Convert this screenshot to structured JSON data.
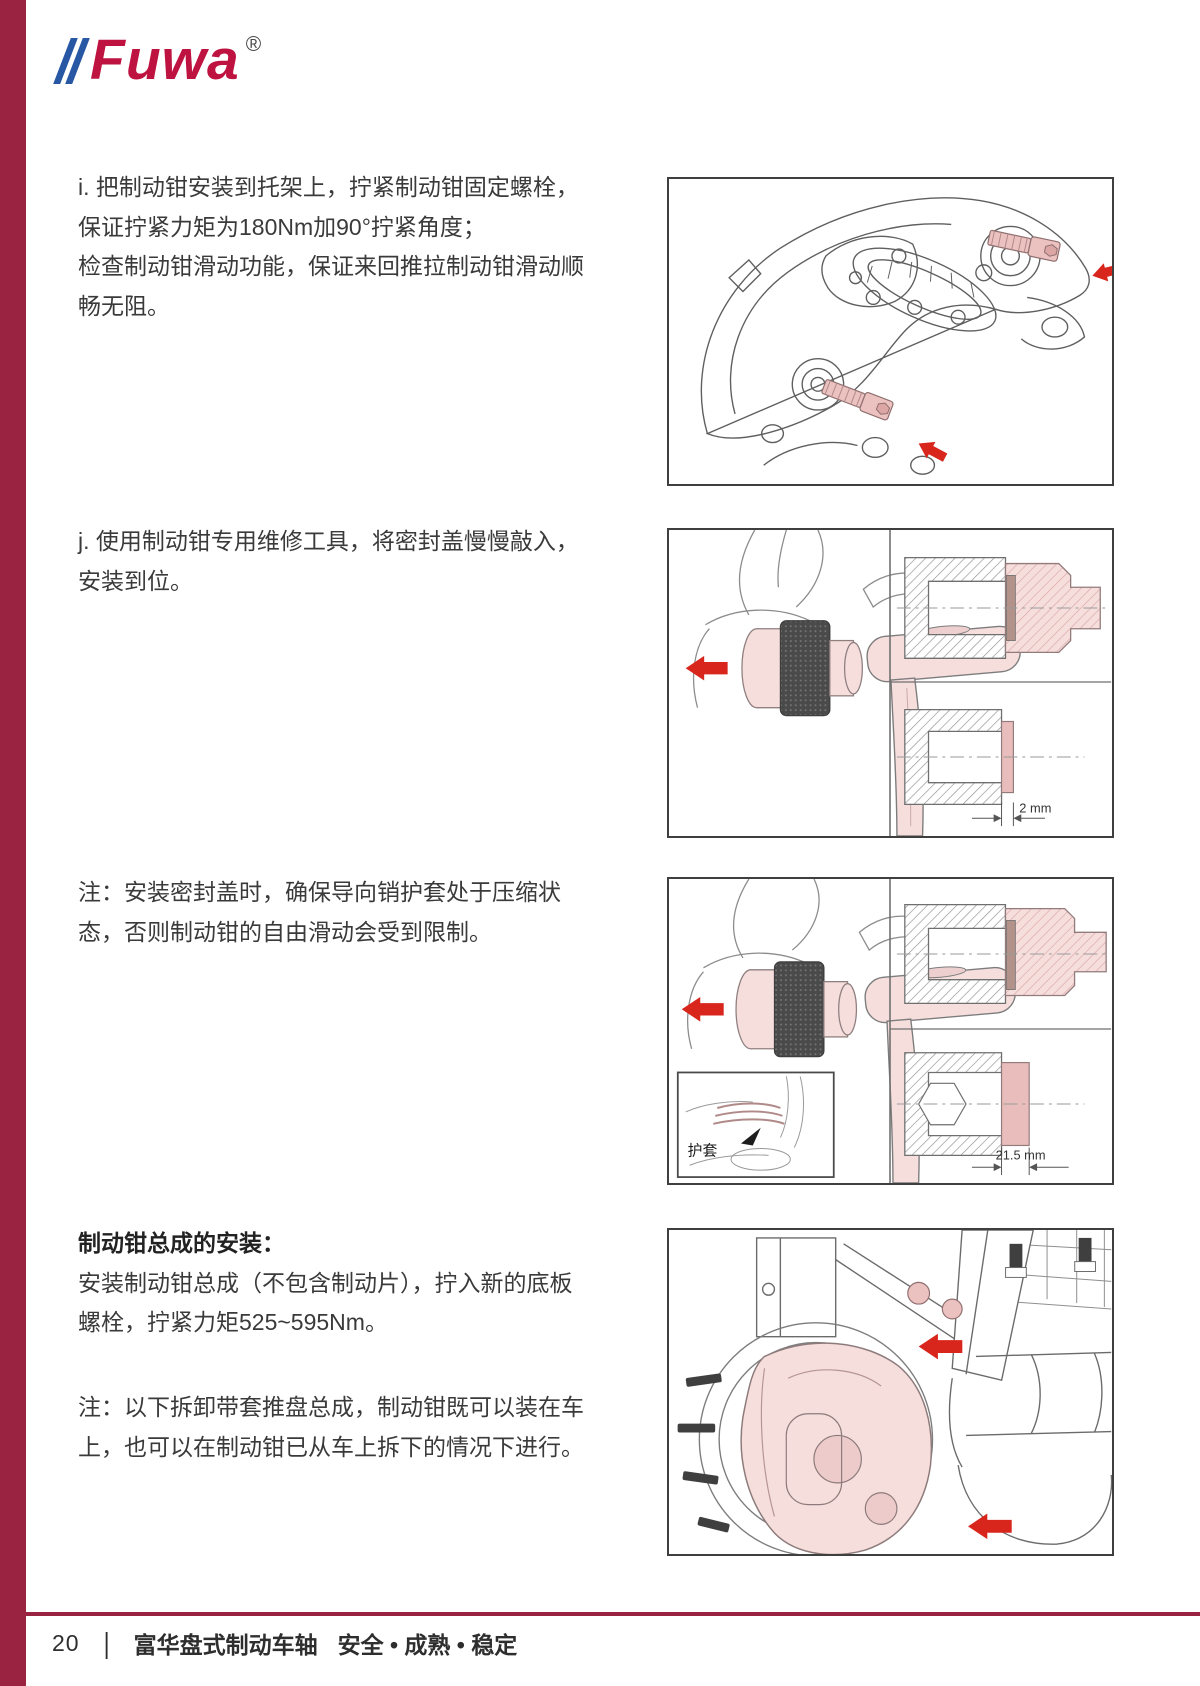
{
  "logo": {
    "text": "Fuwa",
    "registered": "®"
  },
  "colors": {
    "brand_bar_red": "#9a2342",
    "logo_red": "#be1240",
    "logo_blue": "#2857a4",
    "arrow_red": "#d8261d",
    "highlight_pink": "#f6dedd",
    "text_dark": "#3a3a3a"
  },
  "sections": {
    "step_i": {
      "lines": [
        "i. 把制动钳安装到托架上，拧紧制动钳固定螺栓，",
        "保证拧紧力矩为180Nm加90°拧紧角度；",
        "检查制动钳滑动功能，保证来回推拉制动钳滑动顺",
        "畅无阻。"
      ]
    },
    "step_j": {
      "lines": [
        "j. 使用制动钳专用维修工具，将密封盖慢慢敲入，",
        "安装到位。"
      ]
    },
    "note_seal": {
      "lines": [
        "注：安装密封盖时，确保导向销护套处于压缩状",
        "态，否则制动钳的自由滑动会受到限制。"
      ]
    },
    "install": {
      "heading": "制动钳总成的安装：",
      "lines": [
        "安装制动钳总成（不包含制动片），拧入新的底板",
        "螺栓，拧紧力矩525~595Nm。"
      ]
    },
    "note_removal": {
      "lines": [
        "注：以下拆卸带套推盘总成，制动钳既可以装在车",
        "上，也可以在制动钳已从车上拆下的情况下进行。"
      ]
    }
  },
  "figures": {
    "fig2": {
      "dimension_label": "2 mm"
    },
    "fig3": {
      "dimension_label": "21.5 mm",
      "inset_label": "护套"
    }
  },
  "footer": {
    "page_number": "20",
    "separator": "|",
    "title": "富华盘式制动车轴",
    "tagline": "安全 • 成熟 • 稳定"
  }
}
